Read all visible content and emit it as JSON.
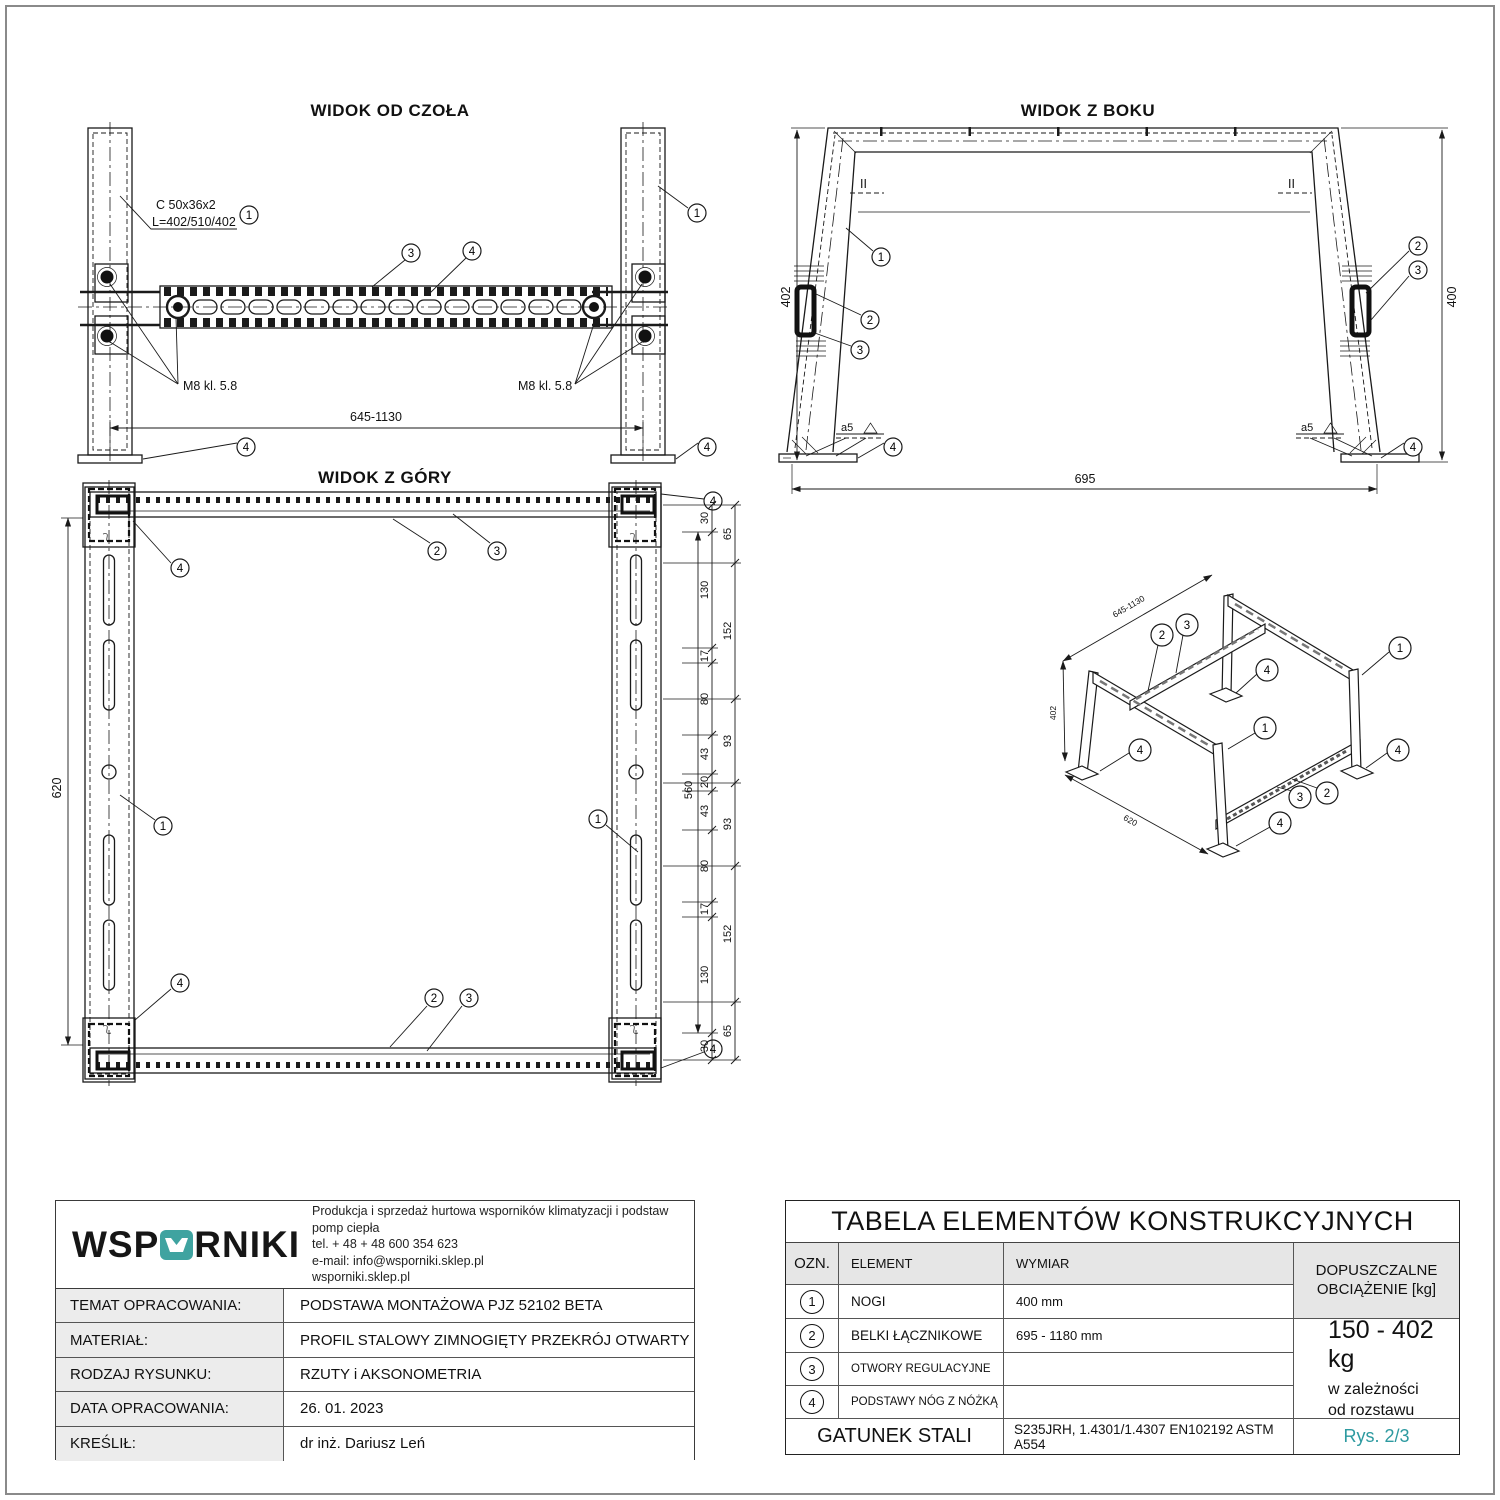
{
  "callouts": {
    "c1": "1",
    "c2": "2",
    "c3": "3",
    "c4": "4"
  },
  "views": {
    "front": {
      "title": "WIDOK OD CZOŁA",
      "profile1": "C 50x36x2",
      "profile2": "L=402/510/402",
      "m8_left": "M8 kl. 5.8",
      "m8_right": "M8 kl. 5.8",
      "dim_span": "645-1130"
    },
    "side": {
      "title": "WIDOK Z BOKU",
      "dim_left": "402",
      "dim_right": "400",
      "dim_bottom": "695",
      "weld_left": "a5",
      "weld_right": "a5",
      "parallel_left": "II",
      "parallel_right": "II"
    },
    "top": {
      "title": "WIDOK Z GÓRY",
      "dim_left": "620",
      "dim_inner": "560",
      "chain_mid": [
        "30",
        "130",
        "17",
        "80",
        "43",
        "20",
        "43",
        "80",
        "17",
        "130",
        "30"
      ],
      "chain_out": [
        "65",
        "152",
        "93",
        "93",
        "152",
        "65"
      ]
    },
    "axo": {
      "dim_beam": "645-1130",
      "dim_height": "402",
      "dim_depth": "620"
    }
  },
  "title_block": {
    "logo_pre": "WSP",
    "logo_post": "RNIKI",
    "company_line1": "Produkcja i sprzedaż hurtowa wsporników klimatyzacji i podstaw pomp ciepła",
    "company_line2": "tel. + 48 + 48 600 354 623",
    "company_line3": "e-mail: info@wsporniki.sklep.pl",
    "company_line4": "wsporniki.sklep.pl",
    "rows": [
      {
        "label": "TEMAT OPRACOWANIA:",
        "value": "PODSTAWA MONTAŻOWA PJZ 52102 BETA"
      },
      {
        "label": "MATERIAŁ:",
        "value": "PROFIL STALOWY ZIMNOGIĘTY PRZEKRÓJ OTWARTY"
      },
      {
        "label": "RODZAJ RYSUNKU:",
        "value": "RZUTY i AKSONOMETRIA"
      },
      {
        "label": "DATA OPRACOWANIA:",
        "value": "26. 01. 2023"
      },
      {
        "label": "KREŚLIŁ:",
        "value": "dr inż. Dariusz Leń"
      }
    ]
  },
  "table": {
    "title": "TABELA ELEMENTÓW KONSTRUKCYJNYCH",
    "col_ozn": "OZN.",
    "col_element": "ELEMENT",
    "col_wymiar": "WYMIAR",
    "load_header_line1": "DOPUSZCZALNE",
    "load_header_line2": "OBCIĄŻENIE [kg]",
    "rows": [
      {
        "ozn": "1",
        "element": "NOGI",
        "wymiar": "400 mm"
      },
      {
        "ozn": "2",
        "element": "BELKI ŁĄCZNIKOWE",
        "wymiar": "695 - 1180 mm"
      },
      {
        "ozn": "3",
        "element": "OTWORY REGULACYJNE",
        "wymiar": ""
      },
      {
        "ozn": "4",
        "element": "PODSTAWY NÓG Z NÓŻKĄ",
        "wymiar": ""
      }
    ],
    "load_value": "150 - 402 kg",
    "load_note1": "w zależności",
    "load_note2": "od rozstawu",
    "steel_label": "GATUNEK STALI",
    "steel_value": "S235JRH, 1.4301/1.4307  EN102192 ASTM A554",
    "sheet": "Rys. 2/3"
  },
  "colors": {
    "accent_teal": "#2d9aa0",
    "logo_teal": "#3fa3a0",
    "line": "#1a1a1a",
    "header_gray": "#e6e6e6"
  }
}
